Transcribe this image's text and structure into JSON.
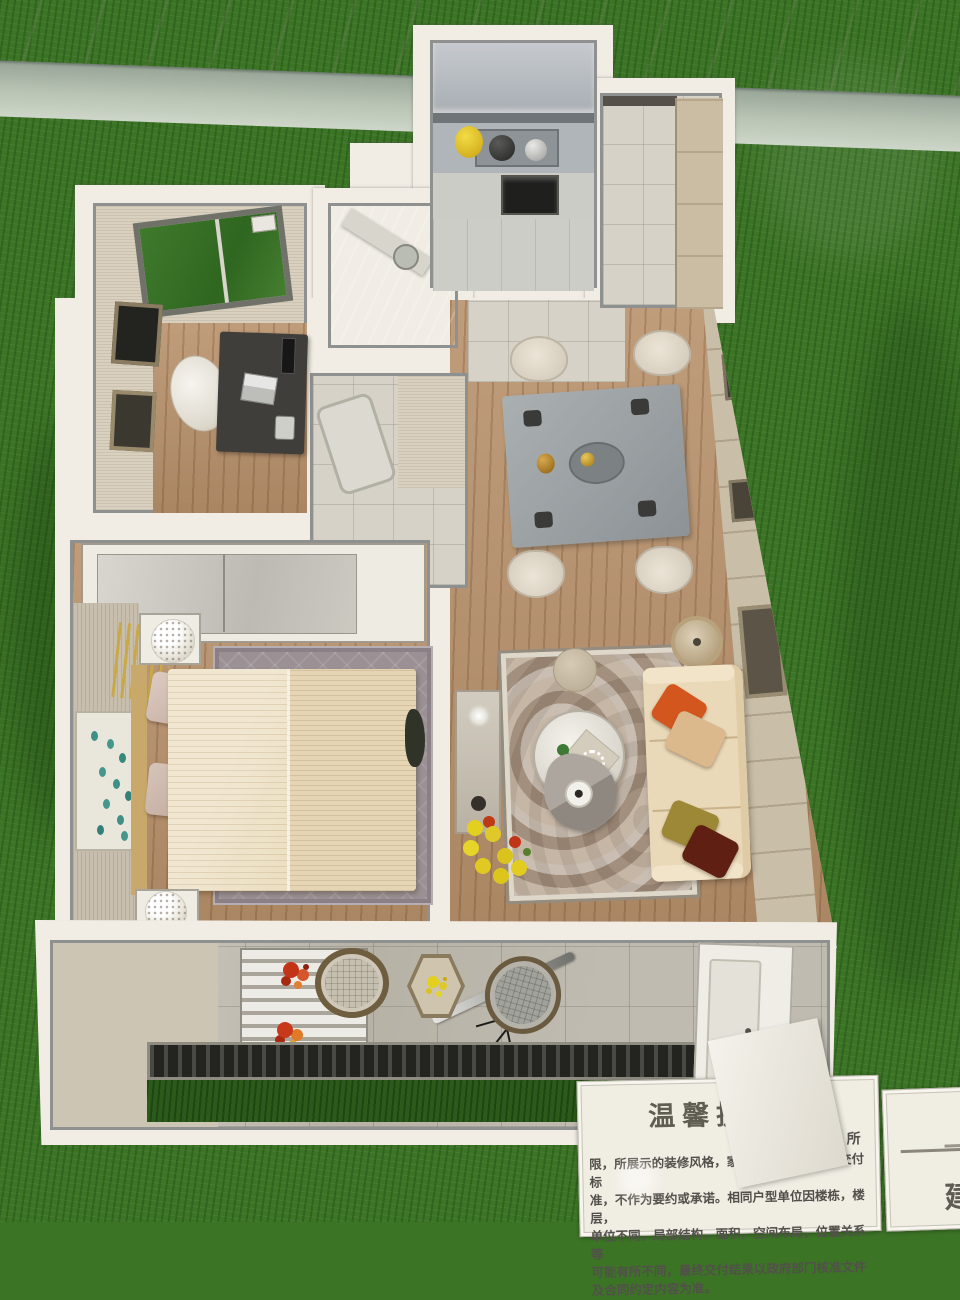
{
  "scene": {
    "description": "Top-down photograph of a miniature apartment sales model (dollhouse-style floor plan) displayed on artificial green turf with a marble ledge at top and notice cards at bottom right",
    "palette": {
      "grass": "#3c7426",
      "grass_dark_patch": "#2c5a1a",
      "marble_ledge": "#e9e3d7",
      "glass_edge": "#a9b4a7",
      "model_wall": "#f1ede5",
      "wall_cap_gray": "#8f9190",
      "wood_floor": "#b8916b",
      "tile_floor": "#d6d2c7",
      "beige_wall": "#d9d0bf",
      "sofa_leather": "#ead9b8",
      "bed_linen": "#ecdfc2",
      "dining_table_marble": "#9ba0a2",
      "living_rug": "#b3a291",
      "bedroom_rug": "#9b9195",
      "pillow_orange": "#d4561f",
      "pillow_tan": "#dcb88d",
      "pillow_olive": "#9c8836",
      "pillow_maroon": "#5f1f12",
      "flower_yellow": "#e3cf1e",
      "flower_red": "#c23318",
      "sign_paper": "#f0ede3",
      "sign_text": "#52504a"
    },
    "rooms": [
      "study",
      "bathroom",
      "kitchen",
      "entry-hall",
      "second-bathroom",
      "dining-area",
      "living-room",
      "master-bedroom",
      "balcony"
    ]
  },
  "signs": {
    "notice": {
      "title": "温馨提示",
      "corner_fragment": "所",
      "body_lines": [
        "限，所展示的装修风格，家具陈设，景观等非交付标",
        "准，不作为要约或承诺。相同户型单位因楼栋，楼层，",
        "单位不同，局部结构，面积，空间布局，位置关系等",
        "可能有所不同，最终交付结果以政府部门核准文件",
        "及合同约定内容为准。"
      ]
    },
    "side_card": {
      "visible_text": "建"
    }
  }
}
